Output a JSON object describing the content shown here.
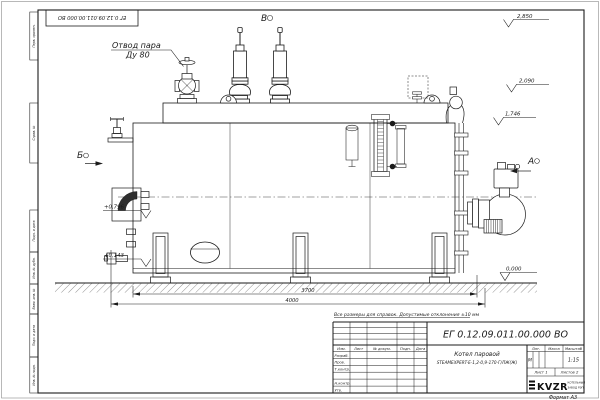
{
  "colors": {
    "ink": "#1b1b1b",
    "paper": "#ffffff"
  },
  "sheet": {
    "stamp_rotated": "ЕГ 0.12.09.011.00.000  ВО",
    "format_label": "Формат А3",
    "margin_labels": [
      "Перв. примен.",
      "Справ. №",
      "Подп. и дата",
      "Инв. № дубл.",
      "Взам. инв. №",
      "Подп. и дата",
      "Инв. № подл."
    ]
  },
  "drawing": {
    "callout_line1": "Отвод пара",
    "callout_line2": "Ду 80",
    "view_top": "В",
    "view_left": "Б",
    "view_right": "А",
    "elev_2850": "2,850",
    "elev_2090": "2,090",
    "elev_1746": "1,746",
    "elev_0796": "+0,796",
    "elev_0143": "+0,143",
    "elev_0000": "0,000",
    "dim_3700": "3700",
    "dim_4000": "4000",
    "note": "Все размеры для справок. Допустимые отклонения ±10 мм"
  },
  "title_block": {
    "doc_number": "ЕГ 0.12.09.011.00.000  ВО",
    "product_name": "Котел паровой",
    "product_type": "STEAMEXPERT-Е-1,2-0,9-170-Г/ЛЖ(Ж)",
    "col_izm": "Изм.",
    "col_list": "Лист",
    "col_doc": "№ докум.",
    "col_podp": "Подп.",
    "col_data": "Дата",
    "row_razrab": "Разраб.",
    "row_prov": "Пров.",
    "row_tkontr": "Т.контр.",
    "row_nkontr": "Н.контр.",
    "row_utv": "Утв.",
    "lit_header": "Лит.",
    "lit_value": "М",
    "massa_header": "Масса",
    "masshtab_header": "Масштаб",
    "scale_value": "1:15",
    "sheet_info_left": "Лист 1",
    "sheet_info_right": "Листов 2",
    "logo_text": "KVZR",
    "logo_sub1": "КОТЕЛЬНЫЙ",
    "logo_sub2": "ЗАВОД РЭП"
  }
}
